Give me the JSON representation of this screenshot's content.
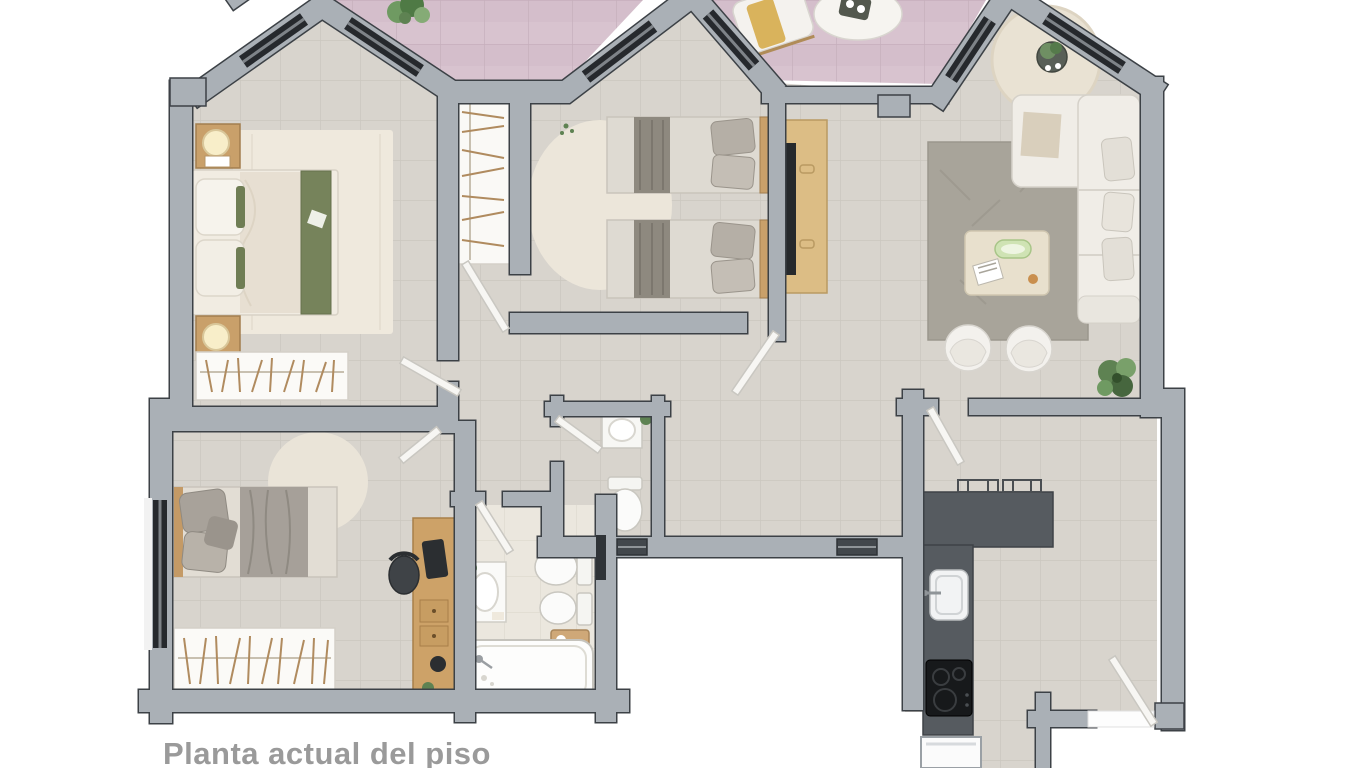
{
  "caption": {
    "text": "Planta actual del piso"
  },
  "palette": {
    "caption_color": "#9a9a9a",
    "wall_fill": "#aab0b6",
    "wall_outline": "#3c4146",
    "floor_tile": "#d8d4cd",
    "floor_grout": "#cbc7bf",
    "terrace_tile": "#d8c3cf",
    "terrace_grout": "#c6afbc",
    "bathroom_floor": "#ebe7de",
    "window_glass": "#26292d",
    "counter_dark": "#565b60",
    "cooktop_black": "#17191b",
    "wood": "#cda268",
    "accent_green": "#76835b",
    "plant_green": "#5e8252",
    "fabric_gray": "#a6a099",
    "white_furniture": "#f3f1ec",
    "door_leaf": "#f7f6f3"
  },
  "floorplan": {
    "type": "apartment-floor-plan-top-view",
    "rooms": [
      {
        "id": "terrace",
        "furniture": [
          "lounge-chair",
          "oval-table",
          "plants"
        ]
      },
      {
        "id": "master-bedroom",
        "furniture": [
          "double-bed",
          "green-runner",
          "two-nightstands",
          "two-lamps",
          "area-rug",
          "closet-with-hangers"
        ]
      },
      {
        "id": "hall-wardrobe",
        "furniture": [
          "wardrobe-with-hangers"
        ]
      },
      {
        "id": "twin-bedroom",
        "furniture": [
          "single-bed",
          "single-bed",
          "round-rug",
          "tv-console",
          "tv"
        ]
      },
      {
        "id": "living-room",
        "furniture": [
          "l-shaped-sofa",
          "coffee-table",
          "two-tub-chairs",
          "gray-rug",
          "round-rug",
          "side-table",
          "plant"
        ]
      },
      {
        "id": "kitchen",
        "furniture": [
          "l-counter",
          "sink",
          "cooktop",
          "appliance",
          "wall-racks"
        ]
      },
      {
        "id": "desk-bedroom",
        "furniture": [
          "single-bed",
          "round-rug",
          "desk",
          "monitor",
          "office-chair",
          "closet-with-hangers"
        ]
      },
      {
        "id": "bathroom",
        "furniture": [
          "vanity-sink",
          "toilet",
          "bidet",
          "bathtub",
          "wood-caddy"
        ]
      },
      {
        "id": "wc",
        "furniture": [
          "sink",
          "toilet"
        ]
      },
      {
        "id": "hallway",
        "furniture": []
      }
    ],
    "doors": [
      "master-bedroom-door",
      "desk-bedroom-door",
      "wardrobe-door",
      "twin-bedroom-door",
      "wc-door",
      "bathroom-door",
      "kitchen-door",
      "exterior-kitchen-door",
      "entry-thresholds"
    ],
    "windows": [
      "gable1-left",
      "gable1-right",
      "gable2-left",
      "gable2-right",
      "gable3-left",
      "gable3-right",
      "desk-bedroom-west"
    ]
  }
}
